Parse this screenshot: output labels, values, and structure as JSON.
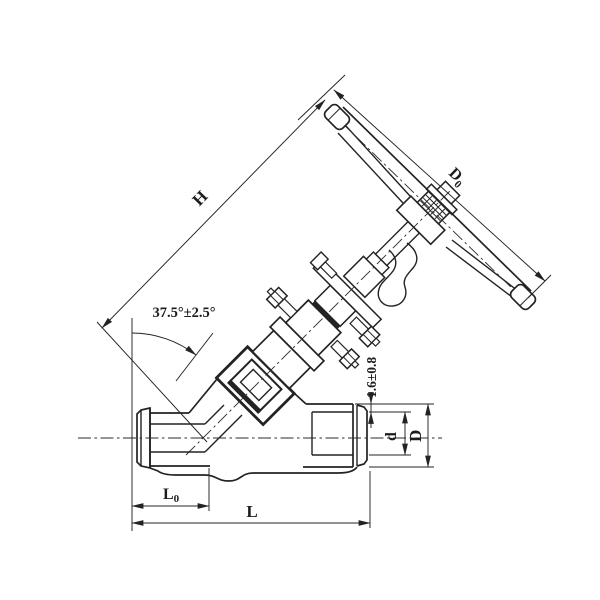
{
  "drawing": {
    "dimensions": {
      "stem_height": {
        "label": "H"
      },
      "handwheel_diameter": {
        "label": "D",
        "subscript": "0"
      },
      "stem_angle": {
        "label": "37.5°±2.5°"
      },
      "socket_end_gap": {
        "label": "1.6±0.8"
      },
      "socket_bore": {
        "label": "d"
      },
      "end_outer_diameter": {
        "label": "D"
      },
      "center_to_face": {
        "label": "L",
        "subscript": "0"
      },
      "face_to_face": {
        "label": "L"
      }
    },
    "colors": {
      "ink": "#232323",
      "paper": "#ffffff"
    }
  }
}
